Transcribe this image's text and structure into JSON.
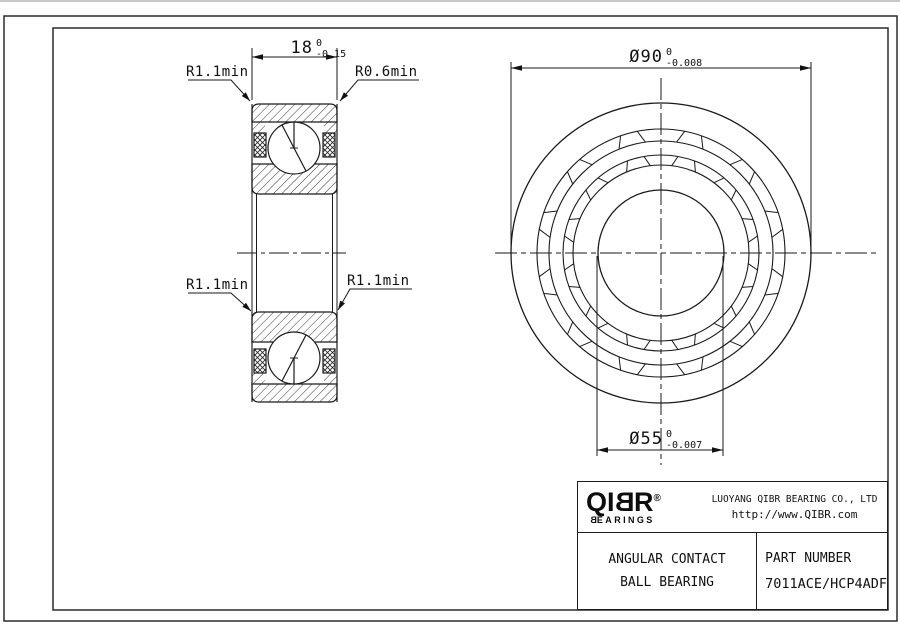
{
  "dimensions": {
    "width": {
      "value": "18",
      "tol_upper": "0",
      "tol_lower": "-0.15"
    },
    "outer_diameter": {
      "value": "Ø90",
      "tol_upper": "0",
      "tol_lower": "-0.008"
    },
    "bore_diameter": {
      "value": "Ø55",
      "tol_upper": "0",
      "tol_lower": "-0.007"
    }
  },
  "radius_labels": {
    "top_left": "R1.1min",
    "top_right": "R0.6min",
    "bottom_left": "R1.1min",
    "bottom_right": "R1.1min"
  },
  "title_block": {
    "logo": {
      "part1": "QI",
      "part2": "B",
      "part3": "R",
      "registered": "®",
      "sub_part1": "B",
      "sub_part2": "EARINGS"
    },
    "company": "LUOYANG QIBR BEARING CO., LTD",
    "website": "http://www.QIBR.com",
    "product_line1": "ANGULAR CONTACT",
    "product_line2": "BALL BEARING",
    "part_number_label": "PART NUMBER",
    "part_number": "7011ACE/HCP4ADF"
  },
  "colors": {
    "line": "#1a1a1a",
    "background": "#ffffff",
    "border": "#2b2b2b"
  }
}
